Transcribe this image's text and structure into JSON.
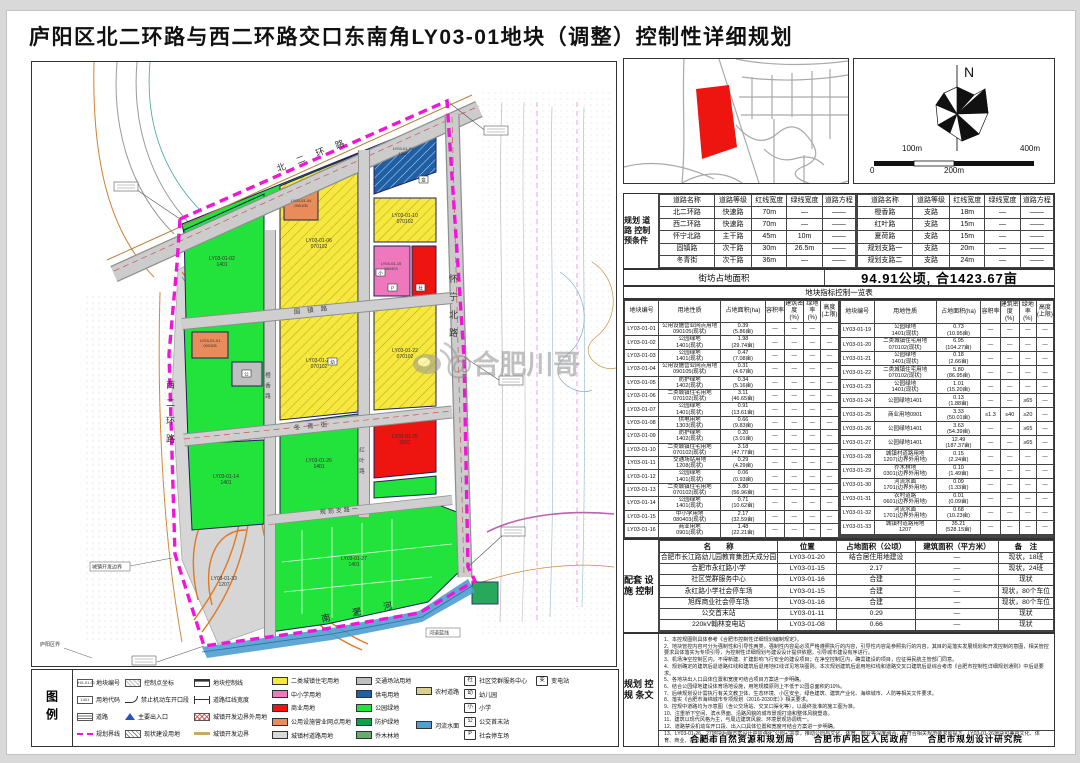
{
  "title": "庐阳区北二环路与西二环路交口东南角LY03-01地块（调整）控制性详细规划",
  "colors": {
    "residential": "#f5e93d",
    "school": "#ef77bc",
    "commercial": "#ee1511",
    "utility_retail": "#e98b5a",
    "town_road": "#d9d9d9",
    "transport": "#bfbfbf",
    "power": "#1f5fa6",
    "park": "#22e23c",
    "protective": "#0fa04a",
    "forest": "#67ab6e",
    "rural_road": "#d8cf92",
    "river": "#4e9fd2",
    "boundary": "#f015d8"
  },
  "compass": {
    "north": "N",
    "scale": {
      "l100": "100m",
      "l400": "400m",
      "l0": "0",
      "l200": "200m"
    }
  },
  "road_control": {
    "label": "规划\n道路\n控制\n预条件",
    "headers": [
      "道路名称",
      "道路等级",
      "红线宽度",
      "绿线宽度",
      "道路方程"
    ],
    "left_rows": [
      [
        "北二环路",
        "快速路",
        "70m",
        "—",
        "——"
      ],
      [
        "西二环路",
        "快速路",
        "70m",
        "—",
        "——"
      ],
      [
        "怀宁北路",
        "主干路",
        "45m",
        "10m",
        "——"
      ],
      [
        "固镇路",
        "次干路",
        "30m",
        "26.5m",
        "——"
      ],
      [
        "冬青街",
        "次干路",
        "36m",
        "—",
        "——"
      ]
    ],
    "right_rows": [
      [
        "橙香路",
        "支路",
        "18m",
        "—",
        "——"
      ],
      [
        "红叶路",
        "支路",
        "15m",
        "—",
        "——"
      ],
      [
        "夏荷路",
        "支路",
        "15m",
        "—",
        "——"
      ],
      [
        "规划支路一",
        "支路",
        "20m",
        "—",
        "——"
      ],
      [
        "规划支路二",
        "支路",
        "24m",
        "—",
        "——"
      ]
    ]
  },
  "block_area": {
    "label": "街坊占地面积",
    "value": "94.91公顷, 合1423.67亩"
  },
  "index_table": {
    "title": "地块指标控制一览表",
    "headers": [
      "地块编号",
      "用地性质",
      "占地面积(ha)",
      "容积率",
      "建筑密度\n(%)",
      "绿地率\n(%)",
      "高度\n(上限)"
    ],
    "left_rows": [
      [
        "LY03-01-01",
        "公用设施营业网点用地\n090105(现状)",
        "0.39\n(5.86亩)",
        "—",
        "—",
        "—",
        "—"
      ],
      [
        "LY03-01-02",
        "公园绿地\n1401(现状)",
        "1.98\n(29.74亩)",
        "—",
        "—",
        "—",
        "—"
      ],
      [
        "LY03-01-03",
        "公园绿地\n1401(现状)",
        "0.47\n(7.08亩)",
        "—",
        "—",
        "—",
        "—"
      ],
      [
        "LY03-01-04",
        "公用设施营业网点用地\n090105(现状)",
        "0.31\n(4.67亩)",
        "—",
        "—",
        "—",
        "—"
      ],
      [
        "LY03-01-05",
        "防护绿地\n1402(现状)",
        "0.34\n(5.16亩)",
        "—",
        "—",
        "—",
        "—"
      ],
      [
        "LY03-01-06",
        "二类城镇住宅用地\n070102(现状)",
        "3.11\n(46.65亩)",
        "—",
        "—",
        "—",
        "—"
      ],
      [
        "LY03-01-07",
        "公园绿地\n1401(现状)",
        "0.91\n(13.61亩)",
        "—",
        "—",
        "—",
        "—"
      ],
      [
        "LY03-01-08",
        "供电用地\n1303(现状)",
        "0.66\n(9.83亩)",
        "—",
        "—",
        "—",
        "—"
      ],
      [
        "LY03-01-09",
        "防护绿地\n1402(现状)",
        "0.20\n(3.01亩)",
        "—",
        "—",
        "—",
        "—"
      ],
      [
        "LY03-01-10",
        "二类城镇住宅用地\n070102(现状)",
        "3.18\n(47.77亩)",
        "—",
        "—",
        "—",
        "—"
      ],
      [
        "LY03-01-11",
        "交通场站用地\n1208(现状)",
        "0.29\n(4.29亩)",
        "—",
        "—",
        "—",
        "—"
      ],
      [
        "LY03-01-12",
        "公园绿地\n1401(现状)",
        "0.06\n(0.93亩)",
        "—",
        "—",
        "—",
        "—"
      ],
      [
        "LY03-01-13",
        "二类城镇住宅用地\n070102(现状)",
        "3.80\n(56.96亩)",
        "—",
        "—",
        "—",
        "—"
      ],
      [
        "LY03-01-14",
        "公园绿地\n1401(现状)",
        "0.71\n(10.62亩)",
        "—",
        "—",
        "—",
        "—"
      ],
      [
        "LY03-01-15",
        "中小学用地\n080403(现状)",
        "2.17\n(32.59亩)",
        "—",
        "—",
        "—",
        "—"
      ],
      [
        "LY03-01-16",
        "商业用地\n0901(现状)",
        "1.48\n(22.21亩)",
        "—",
        "—",
        "—",
        "—"
      ],
      [
        "LY03-01-17",
        "公园绿地\n1401(现状)",
        "0.76\n(11.33亩)",
        "—",
        "—",
        "—",
        "—"
      ],
      [
        "LY03-01-18",
        "公园绿地\n1401(现状)",
        "3.61\n(51.14亩)",
        "—",
        "—",
        "—",
        "—"
      ]
    ],
    "right_rows": [
      [
        "LY03-01-19",
        "公园绿地\n1401(现状)",
        "0.73\n(10.95亩)",
        "—",
        "—",
        "—",
        "—"
      ],
      [
        "LY03-01-20",
        "二类城镇住宅用地\n070102(现状)",
        "6.95\n(104.27亩)",
        "—",
        "—",
        "—",
        "—"
      ],
      [
        "LY03-01-21",
        "公园绿地\n1401(现状)",
        "0.18\n(2.66亩)",
        "—",
        "—",
        "—",
        "—"
      ],
      [
        "LY03-01-22",
        "二类城镇住宅用地\n070102(现状)",
        "5.80\n(86.95亩)",
        "—",
        "—",
        "—",
        "—"
      ],
      [
        "LY03-01-23",
        "公园绿地\n1401(现状)",
        "1.01\n(15.20亩)",
        "—",
        "—",
        "—",
        "—"
      ],
      [
        "LY03-01-24",
        "公园绿地1401",
        "0.13\n(1.88亩)",
        "—",
        "—",
        "≥65",
        "—"
      ],
      [
        "LY03-01-25",
        "商业用地0901",
        "3.33\n(50.01亩)",
        "≤1.3",
        "≤40",
        "≥20",
        "—"
      ],
      [
        "LY03-01-26",
        "公园绿地1401",
        "3.63\n(54.39亩)",
        "—",
        "—",
        "≥65",
        "—"
      ],
      [
        "LY03-01-27",
        "公园绿地1401",
        "12.49\n(187.37亩)",
        "—",
        "—",
        "≥65",
        "—"
      ],
      [
        "LY03-01-28",
        "城镇村道路用地\n1207(边界外用地)",
        "0.15\n(2.24亩)",
        "—",
        "—",
        "—",
        "—"
      ],
      [
        "LY03-01-29",
        "乔木林地\n0301(边界外用地)",
        "0.10\n(1.49亩)",
        "—",
        "—",
        "—",
        "—"
      ],
      [
        "LY03-01-30",
        "河流水面\n1701(边界外用地)",
        "0.09\n(1.33亩)",
        "—",
        "—",
        "—",
        "—"
      ],
      [
        "LY03-01-31",
        "农村道路\n0601(边界外用地)",
        "0.01\n(0.09亩)",
        "—",
        "—",
        "—",
        "—"
      ],
      [
        "LY03-01-32",
        "河流水面\n1701(边界外用地)",
        "0.68\n(10.23亩)",
        "—",
        "—",
        "—",
        "—"
      ],
      [
        "LY03-01-33",
        "城镇村道路用地\n1207",
        "35.21\n(528.15亩)",
        "—",
        "—",
        "—",
        "—"
      ],
      [
        "",
        "",
        "",
        "",
        "",
        "",
        ""
      ],
      [
        "",
        "",
        "",
        "",
        "",
        "",
        ""
      ],
      [
        "",
        "",
        "",
        "",
        "",
        "",
        ""
      ]
    ]
  },
  "facilities": {
    "label": "配套\n设施\n控制",
    "headers": [
      "名　　称",
      "位置",
      "占地面积（公顷）",
      "建筑面积（平方米）",
      "备　注"
    ],
    "rows": [
      [
        "合肥市长江路幼儿园教育集团天成分园",
        "LY03-01-20",
        "结合居住用地建设",
        "—",
        "现状，18班"
      ],
      [
        "合肥市永红路小学",
        "LY03-01-15",
        "2.17",
        "—",
        "现状，24班"
      ],
      [
        "社区党群服务中心",
        "LY03-01-16",
        "合建",
        "—",
        "现状"
      ],
      [
        "永红路小学社会停车场",
        "LY03-01-15",
        "合建",
        "—",
        "现状，80个车位"
      ],
      [
        "旭辉商业社会停车场",
        "LY03-01-16",
        "合建",
        "—",
        "现状，80个车位"
      ],
      [
        "公交首末站",
        "LY03-01-11",
        "0.29",
        "—",
        "现状"
      ],
      [
        "220kV翰林变电站",
        "LY03-01-08",
        "0.66",
        "—",
        "现状"
      ],
      [
        "",
        "",
        "",
        "",
        ""
      ]
    ]
  },
  "notes": {
    "label": "规划\n控规\n条文",
    "items": [
      "1、本控规图则具体参考《合肥市控制性详细规划编制规定》。",
      "2、地块管控内容可分为强制性和引导性两类，强制性内容是必须严格遵照执行的内容，引导性内容是参照执行的内容，其目的是落实发展规划和开发控制的意图，相关管控要求具体落实为专项引导，为控制性详细规划与建设设计提供依据，引导城市建设有序进行。",
      "3、机场净空控制区内，不得新建、扩建影响飞行安全的建设项目；在净空控制区内，确需建设的项目，应征得民航主管部门同意。",
      "4、规划确定的建筑后退道路红线和建筑后退用地红线详见地块图则。本次规划建筑后退用地红线和道路交叉口建筑后退综合考虑《合肥市控制性详细规划通则》中后退要求。",
      "5、各地块出入口具体位置和宽度可结合项目方案进一步明确。",
      "6、结合公园绿地建设体育场地设施，用地规模原则上不低于公园总面积的10%。",
      "7、后续规划设计需执行有关文教卫体、生态环境、小区安全、绿色建筑、建筑产业化、海绵城市、人防等相关文件要求。",
      "8、落实《合肥市海绵城市专项规划（2016-2030年）》相关要求。",
      "9、控规中道路均为示意图（含公交场站、交叉口渠化等），以最终批准的施工图为准。",
      "10、注重桥下空间、滨水界面、沿路风貌的城市景观打造和整体风貌塑造。",
      "11、建筑以现代风格为主，与周边建筑风貌、环境景观协调统一。",
      "12、道路禁设机动车开口段、出入口具体位置和宽度可结合方案进一步明确。",
      "13、LY03-01-26、27地块后期方案设计中应强化“公园+”共享，推动公园与文化、体育、商业等深度融合，在符合相关规范要求前提下，LY03-01-26地块可兼容文化、体育、商业、办公等功能。"
    ],
    "footer": "合肥市自然资源和规划局　　合肥市庐阳区人民政府　　合肥市规划设计研究院"
  },
  "legend": {
    "title": "图例",
    "columns": [
      {
        "items": [
          {
            "t": "boxtext",
            "v": "HX-01-01",
            "label": "地块编号"
          },
          {
            "t": "boxtext",
            "v": "1401",
            "label": "用地代码"
          },
          {
            "t": "road",
            "label": "道路"
          },
          {
            "t": "dashmag",
            "label": "规划界线"
          }
        ]
      },
      {
        "items": [
          {
            "t": "coord",
            "label": "控制点坐标"
          },
          {
            "t": "noopen",
            "label": "禁止机动车开口段"
          },
          {
            "t": "entr",
            "label": "主要出入口"
          },
          {
            "t": "hatch",
            "label": "现状建设用地"
          }
        ]
      },
      {
        "items": [
          {
            "t": "ctrl",
            "label": "地块控制线"
          },
          {
            "t": "redw",
            "label": "道路红线宽度"
          },
          {
            "t": "outb",
            "label": "城镇开发边界外用地"
          },
          {
            "t": "devb",
            "label": "城镇开发边界"
          }
        ]
      },
      {
        "items": [
          {
            "t": "chip",
            "c": "residential",
            "label": "二类城镇住宅用地"
          },
          {
            "t": "chip",
            "c": "school",
            "label": "中小学用地"
          },
          {
            "t": "chip",
            "c": "commercial",
            "label": "商业用地"
          },
          {
            "t": "chip",
            "c": "utility_retail",
            "label": "公用设施营业网点用地"
          },
          {
            "t": "chip",
            "c": "town_road",
            "label": "城镇村道路用地"
          }
        ]
      },
      {
        "items": [
          {
            "t": "chip",
            "c": "transport",
            "label": "交通场站用地"
          },
          {
            "t": "chip",
            "c": "power",
            "label": "供电用地"
          },
          {
            "t": "chip",
            "c": "park",
            "label": "公园绿地"
          },
          {
            "t": "chip",
            "c": "protective",
            "label": "防护绿地"
          },
          {
            "t": "chip",
            "c": "forest",
            "label": "乔木林地"
          }
        ]
      },
      {
        "items": [
          {
            "t": "chip",
            "c": "rural_road",
            "label": "农村道路"
          },
          {
            "t": "chip",
            "c": "river",
            "label": "河流水面"
          }
        ]
      },
      {
        "items": [
          {
            "t": "icon",
            "v": "社",
            "label": "社区党群服务中心",
            "extra": {
              "v": "变",
              "label": "变电站"
            }
          },
          {
            "t": "icon",
            "v": "幼",
            "label": "幼儿园"
          },
          {
            "t": "icon",
            "v": "小",
            "label": "小学"
          },
          {
            "t": "icon",
            "v": "公",
            "label": "公交首末站"
          },
          {
            "t": "icon",
            "v": "P",
            "label": "社会停车场"
          }
        ]
      }
    ]
  },
  "map": {
    "watermark": "@合肥川哥",
    "road_labels": {
      "beihuan": "北二环路",
      "xihuan": "西二环路",
      "huaining": "怀宁北路",
      "guzhen": "固镇路",
      "dongqing": "冬青街",
      "chengxiang": "橙香路",
      "hongye": "红叶路",
      "zhilu1": "规划支路一",
      "nanfei": "南 淝 河",
      "hedao": "河道蓝线",
      "kaifabianjie": "城镇开发边界",
      "luyang": "庐阳区界"
    },
    "blocks": [
      {
        "l1": "LY03-01-02",
        "l2": "1401"
      },
      {
        "l1": "LY03-01-06",
        "l2": "070102"
      },
      {
        "l1": "LY03-01-04",
        "l2": "090105"
      },
      {
        "l1": "LY03-01-08",
        "l2": "1303"
      },
      {
        "l1": "LY03-01-10",
        "l2": "070102"
      },
      {
        "l1": "LY03-01-15",
        "l2": "080403"
      },
      {
        "l1": "LY03-01-01",
        "l2": "090105"
      },
      {
        "l1": "LY03-01-20",
        "l2": "070102"
      },
      {
        "l1": "LY03-01-22",
        "l2": "070102"
      },
      {
        "l1": "LY03-01-14",
        "l2": "1401"
      },
      {
        "l1": "LY03-01-26",
        "l2": "1401"
      },
      {
        "l1": "LY03-01-25",
        "l2": "0901"
      },
      {
        "l1": "LY03-01-27",
        "l2": "1401"
      },
      {
        "l1": "LY03-01-33",
        "l2": "1207"
      }
    ],
    "icons": {
      "power": "变",
      "community": "社",
      "parking": "P",
      "school": "小",
      "kindergarten": "幼",
      "bus": "公"
    }
  }
}
